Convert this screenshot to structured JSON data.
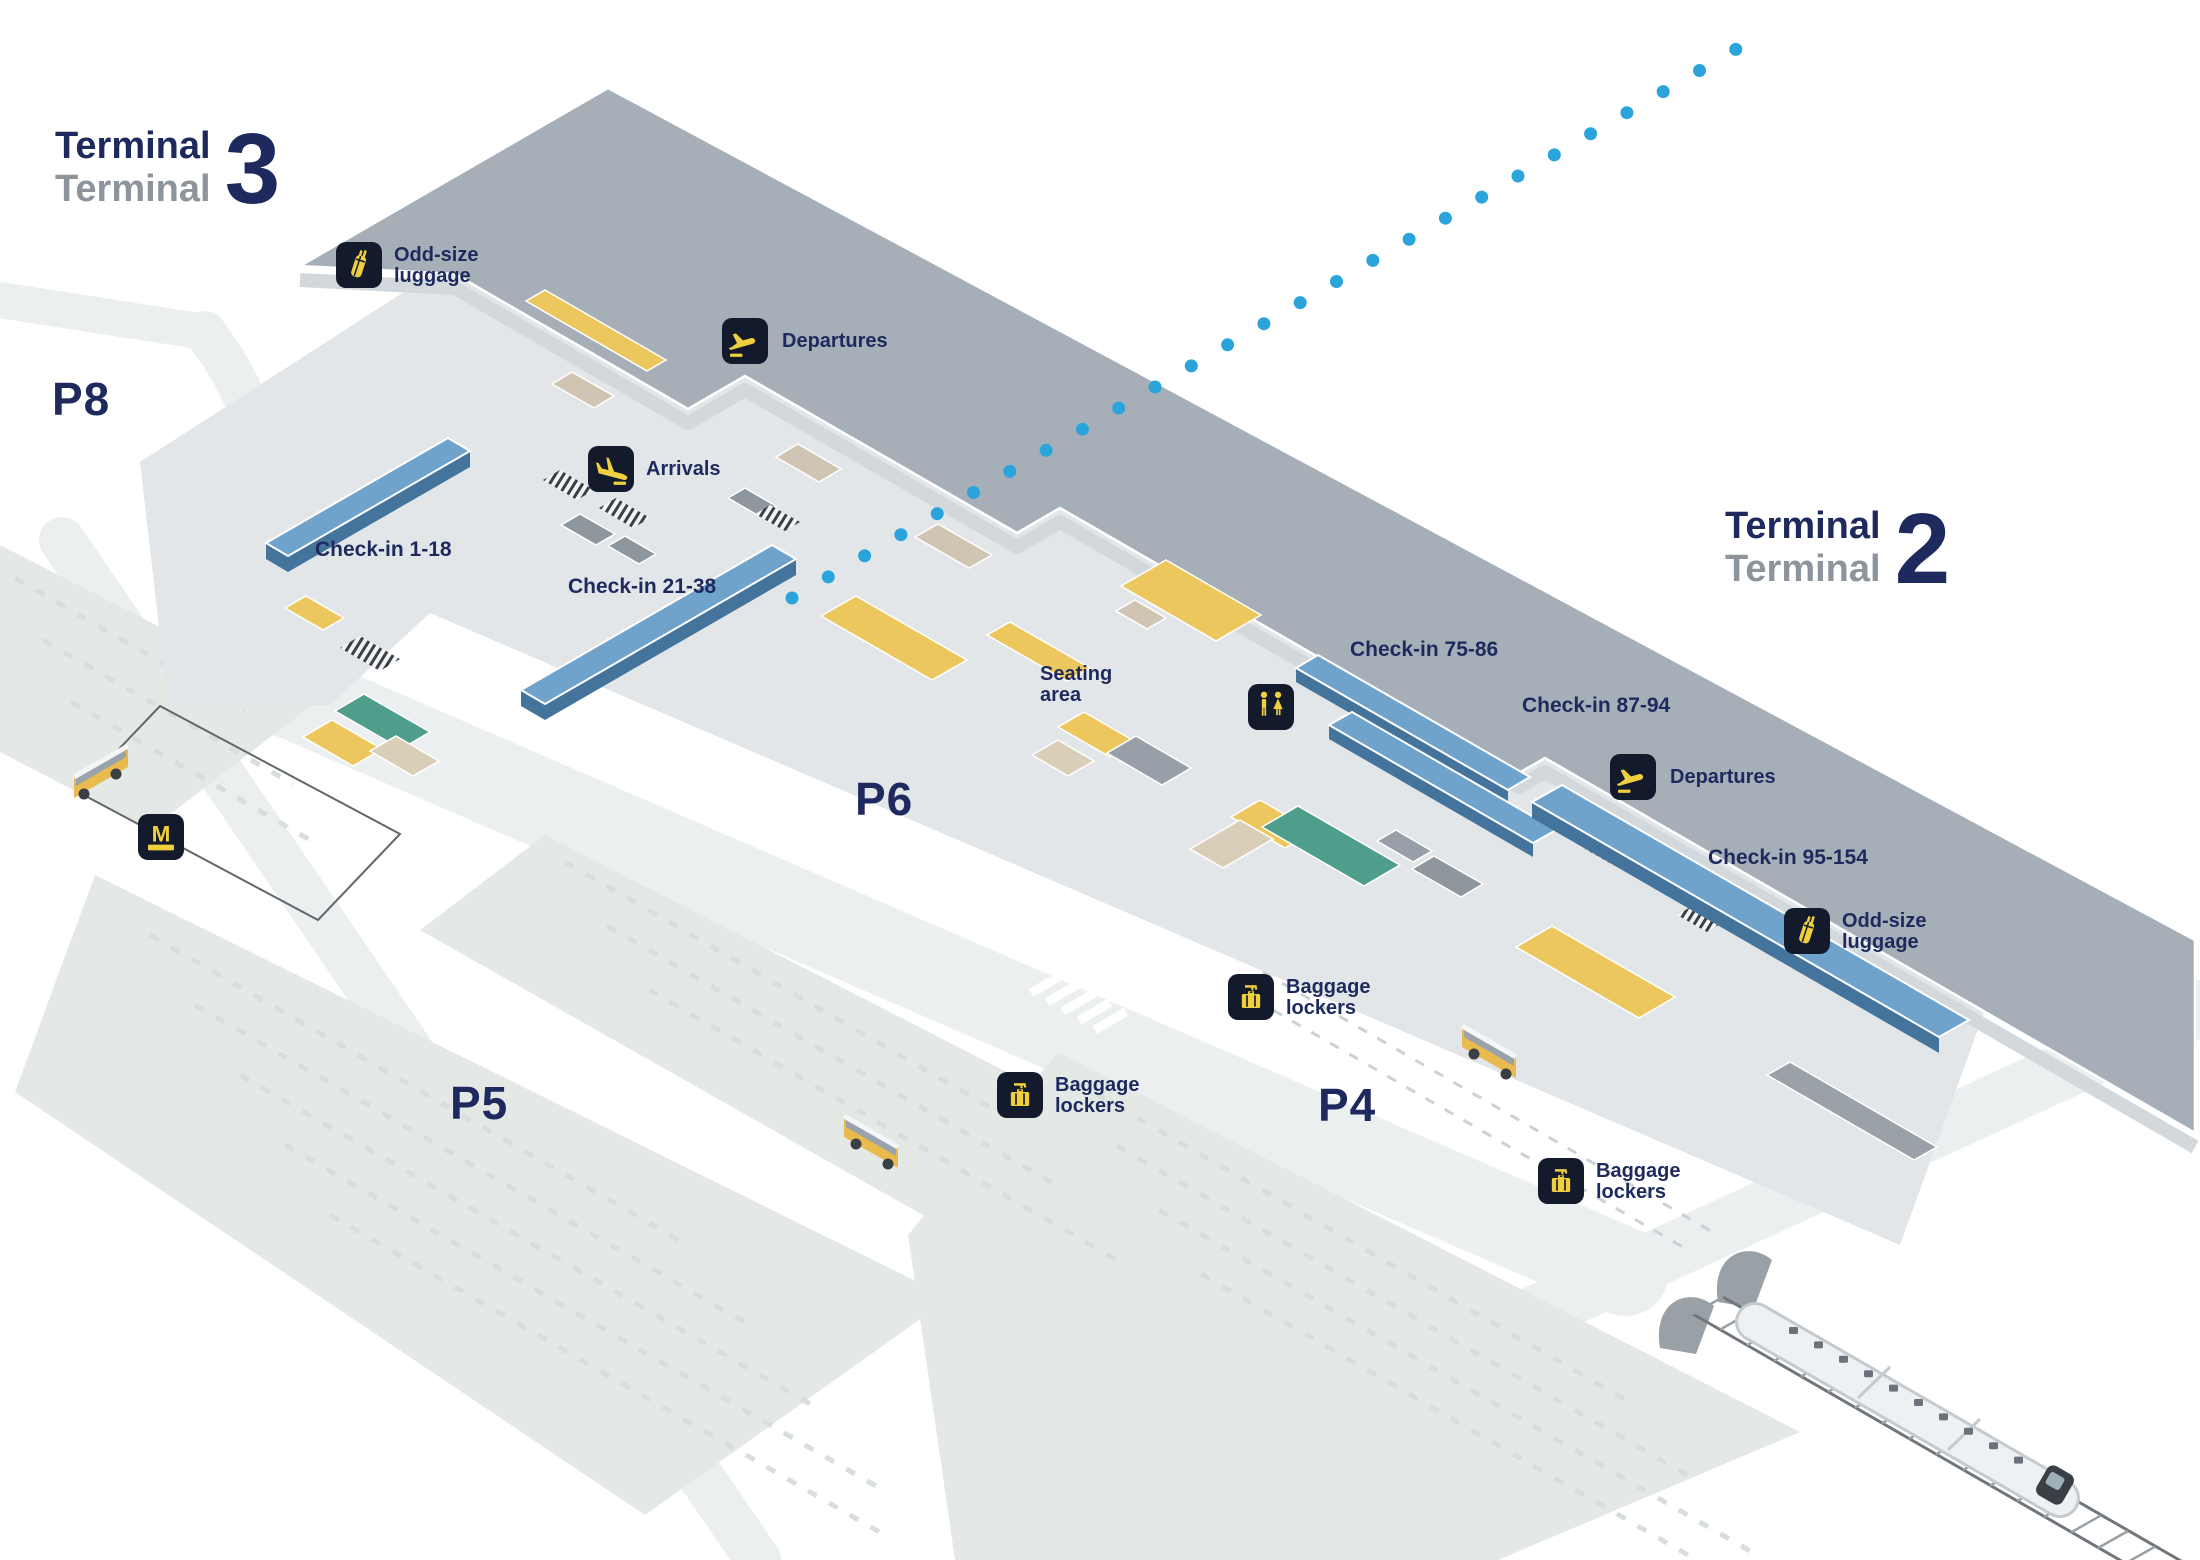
{
  "title": "Airport terminal map",
  "terminals": {
    "t3": {
      "line1": "Terminal",
      "line2": "Terminal",
      "number": "3"
    },
    "t2": {
      "line1": "Terminal",
      "line2": "Terminal",
      "number": "2"
    }
  },
  "parking": {
    "p8": "P8",
    "p6": "P6",
    "p5": "P5",
    "p4": "P4"
  },
  "checkins": {
    "c1_18": "Check-in 1-18",
    "c21_38": "Check-in 21-38",
    "c75_86": "Check-in 75-86",
    "c87_94": "Check-in 87-94",
    "c95_154": "Check-in 95-154"
  },
  "poi": {
    "departures": "Departures",
    "arrivals": "Arrivals",
    "odd_size_line1": "Odd-size",
    "odd_size_line2": "luggage",
    "baggage_line1": "Baggage",
    "baggage_line2": "lockers",
    "seating_line1": "Seating",
    "seating_line2": "area"
  },
  "icons": [
    "odd-size-luggage-icon",
    "departures-icon",
    "arrivals-icon",
    "toilets-icon",
    "baggage-lockers-icon",
    "metro-icon"
  ],
  "colors": {
    "label_navy": "#1e2a5e",
    "label_gray": "#8d949b",
    "roof_gray": "#a6afb7",
    "floor_gray": "#e2e6e9",
    "checkin_desk_blue": "#6fa3cc",
    "accent_yellow": "#ecc75e",
    "teal": "#4f9e8c",
    "beige": "#d9ceb8",
    "icon_background": "#131a2c",
    "icon_yellow": "#f0cf3f",
    "dotted_line_blue": "#2aa4db",
    "parking_field": "#e5e9e6",
    "road": "#eceff0"
  }
}
